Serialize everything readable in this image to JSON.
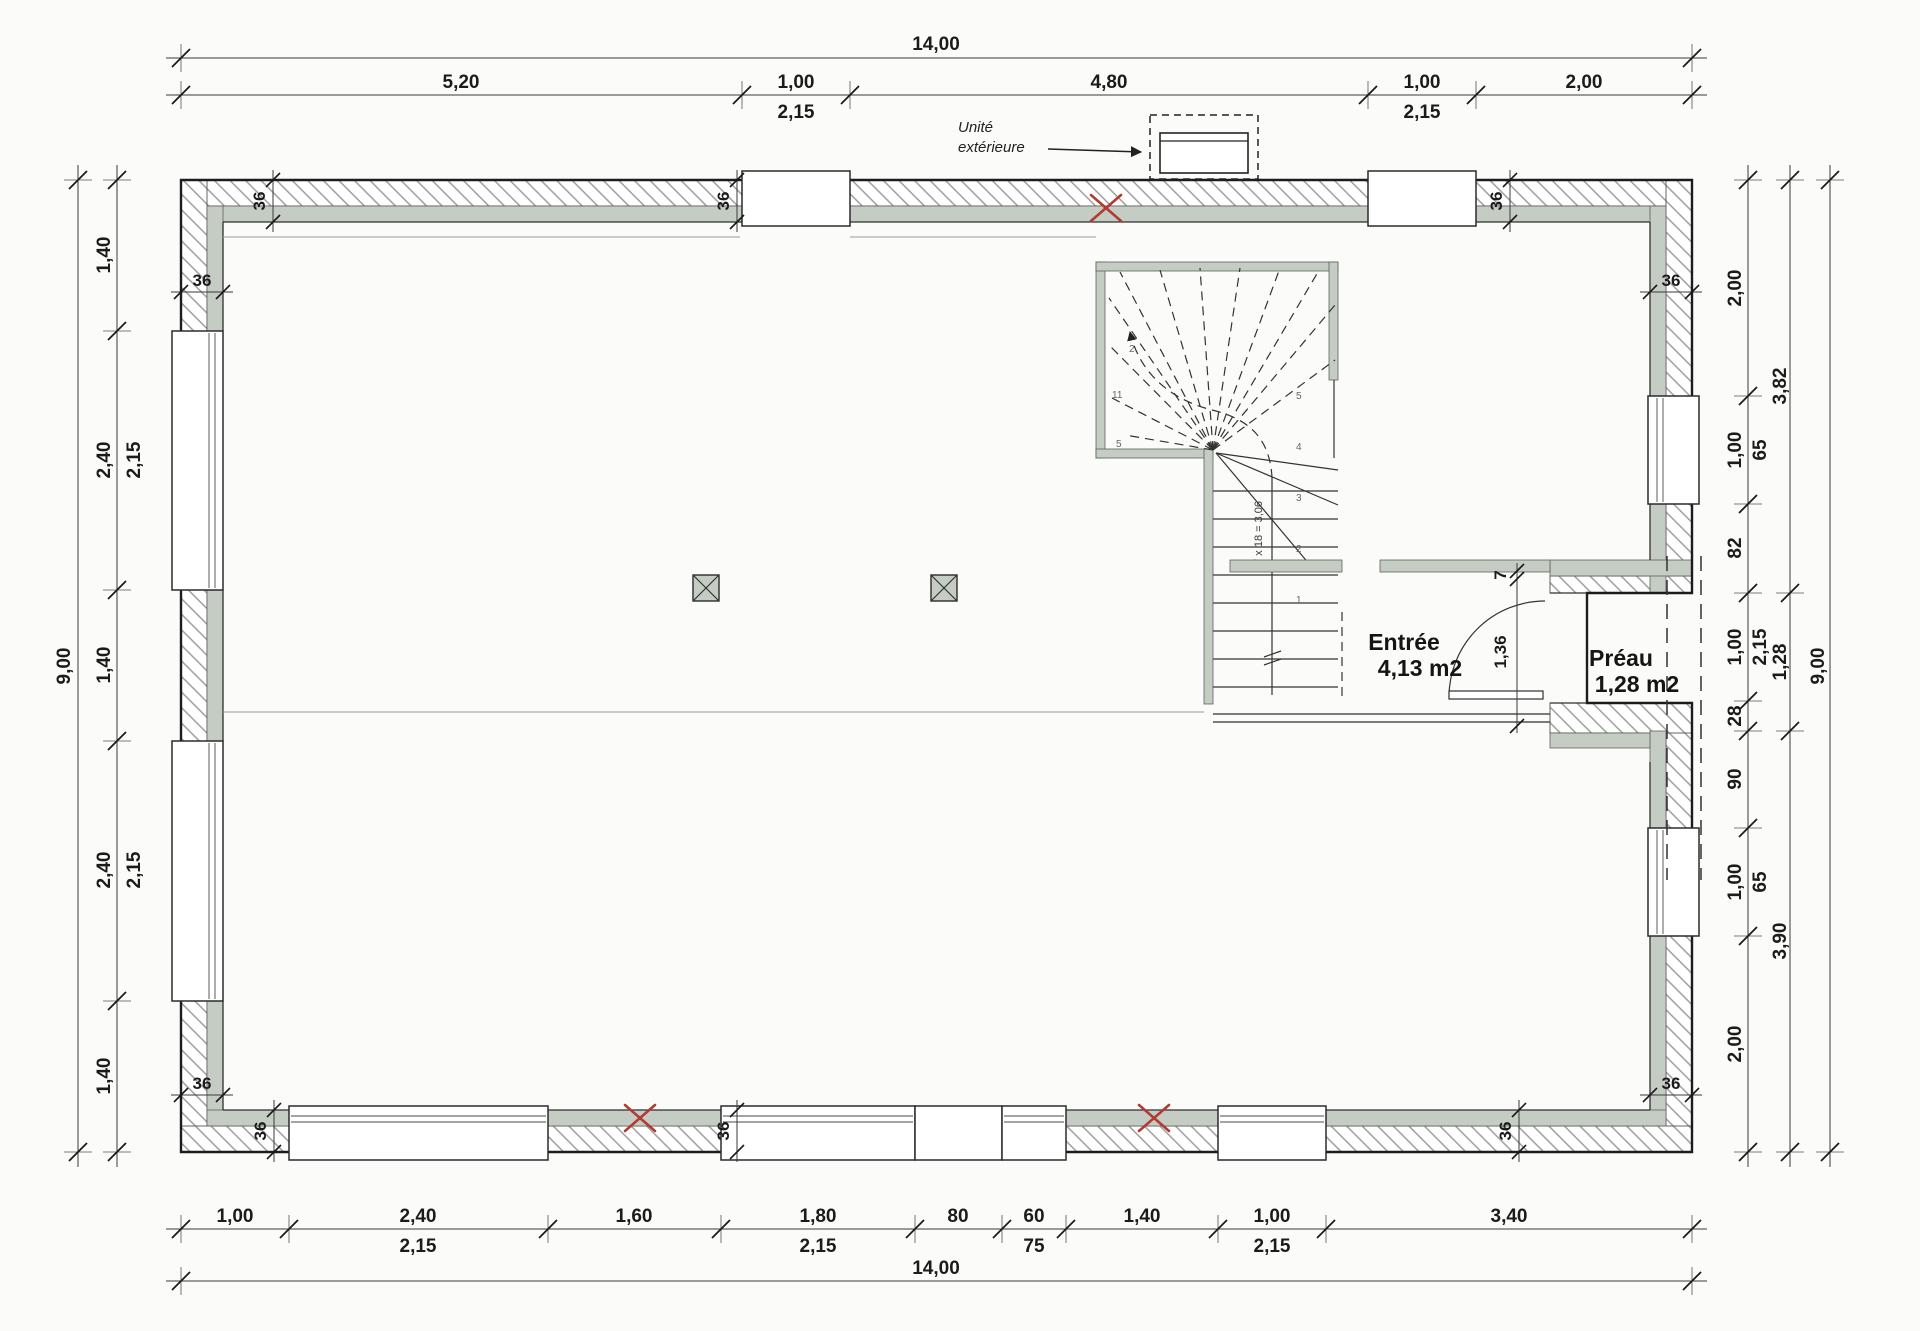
{
  "plan": {
    "dimensions": {
      "top": {
        "overall": "14,00",
        "seg1": "5,20",
        "seg2": "1,00",
        "seg2_sub": "2,15",
        "seg3": "4,80",
        "seg4": "1,00",
        "seg4_sub": "2,15",
        "seg5": "2,00"
      },
      "bottom": {
        "overall": "14,00",
        "seg1": "1,00",
        "seg2": "2,40",
        "seg2_sub": "2,15",
        "seg3": "1,60",
        "seg4": "1,80",
        "seg4_sub": "2,15",
        "seg5": "80",
        "seg6": "60",
        "seg6_sub": "75",
        "seg7": "1,40",
        "seg8": "1,00",
        "seg8_sub": "2,15",
        "seg9": "3,40"
      },
      "left": {
        "overall": "9,00",
        "seg1": "1,40",
        "seg2": "2,40",
        "seg2_sub": "2,15",
        "seg3": "1,40",
        "seg4": "2,40",
        "seg4_sub": "2,15",
        "seg5": "1,40"
      },
      "right": {
        "overall": "9,00",
        "mid1": "3,82",
        "mid2": "1,28",
        "mid3": "3,90",
        "seg1": "2,00",
        "seg2": "1,00",
        "seg2_sub": "65",
        "seg3": "82",
        "seg4": "1,00",
        "seg4_sub": "2,15",
        "seg5": "28",
        "seg6": "90",
        "seg7": "1,00",
        "seg7_sub": "65",
        "seg8": "2,00"
      },
      "wall_thickness": "36",
      "door_step": "7",
      "door_height": "1,36"
    },
    "rooms": {
      "entree": {
        "name": "Entrée",
        "area": "4,13 m2"
      },
      "preau": {
        "name": "Préau",
        "area": "1,28 m2"
      }
    },
    "annotations": {
      "exterior_unit_line1": "Unité",
      "exterior_unit_line2": "extérieure",
      "stair_formula": "17 x 18 = 3,06",
      "stair_marks": {
        "w1": "2",
        "w2": "11",
        "w3": "5",
        "f1": "5",
        "f2": "4",
        "f3": "3",
        "f4": "2",
        "f5": "1"
      }
    },
    "colors": {
      "wall_insulation": "#c5ccc4",
      "line": "#2a2a2a",
      "hatch": "#979797",
      "red_mark": "#b23a32",
      "dim_text": "#1b1b1b"
    }
  }
}
